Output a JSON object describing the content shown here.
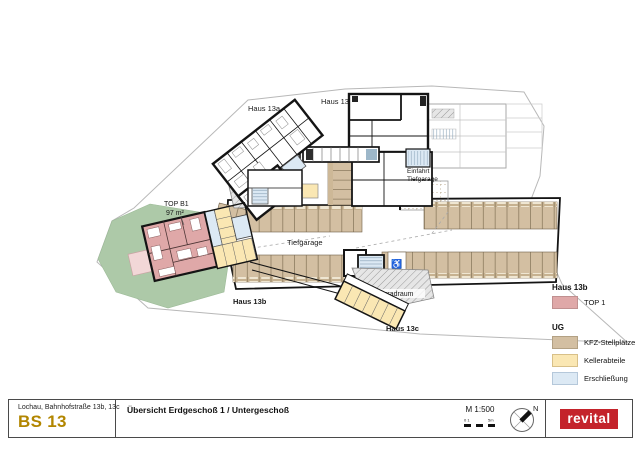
{
  "meta": {
    "sheet_kind": "architectural overview plan"
  },
  "colors": {
    "project_gold": "#b28600",
    "logo_red": "#c4232b",
    "top1_pink": "#dfa8a8",
    "terrace_pink": "#f2d7d7",
    "kfz_tan": "#d3bfa2",
    "keller_yellow": "#fae7b3",
    "erschliessung_blue": "#dce9f4",
    "garden_green": "#adc9a8"
  },
  "plan": {
    "labels": {
      "haus_13a": "Haus 13a",
      "haus_13": "Haus 13",
      "haus_13b": "Haus 13b",
      "haus_13c": "Haus 13c",
      "einfahrt_line1": "Einfahrt",
      "einfahrt_line2": "Tiefgarage",
      "tiefgarage": "Tiefgarage",
      "fahrradraum_nord": "Fahrradraum",
      "fahrradraum_sued": "Fahrradraum",
      "top_b1": "TOP B1",
      "top_b1_flaeche": "97 m²",
      "accessible_icon": "♿"
    }
  },
  "legend": {
    "groups": [
      {
        "title": "Haus 13b",
        "items": [
          {
            "label": "TOP 1",
            "color": "#dfa8a8"
          }
        ]
      },
      {
        "title": "UG",
        "items": [
          {
            "label": "KFZ-Stellplätze",
            "color": "#d3bfa2"
          },
          {
            "label": "Kellerabteile",
            "color": "#fae7b3"
          },
          {
            "label": "Erschließung",
            "color": "#dce9f4"
          }
        ]
      }
    ]
  },
  "titlebar": {
    "address": "Lochau, Bahnhofstraße 13b, 13c",
    "project_code": "BS 13",
    "sheet_title": "Übersicht Erdgeschoß 1 / Untergeschoß",
    "scale_label": "M 1:500",
    "scalebar_start": "0 1",
    "scalebar_end": "5m",
    "north_label": "N",
    "logo_text": "revital"
  }
}
